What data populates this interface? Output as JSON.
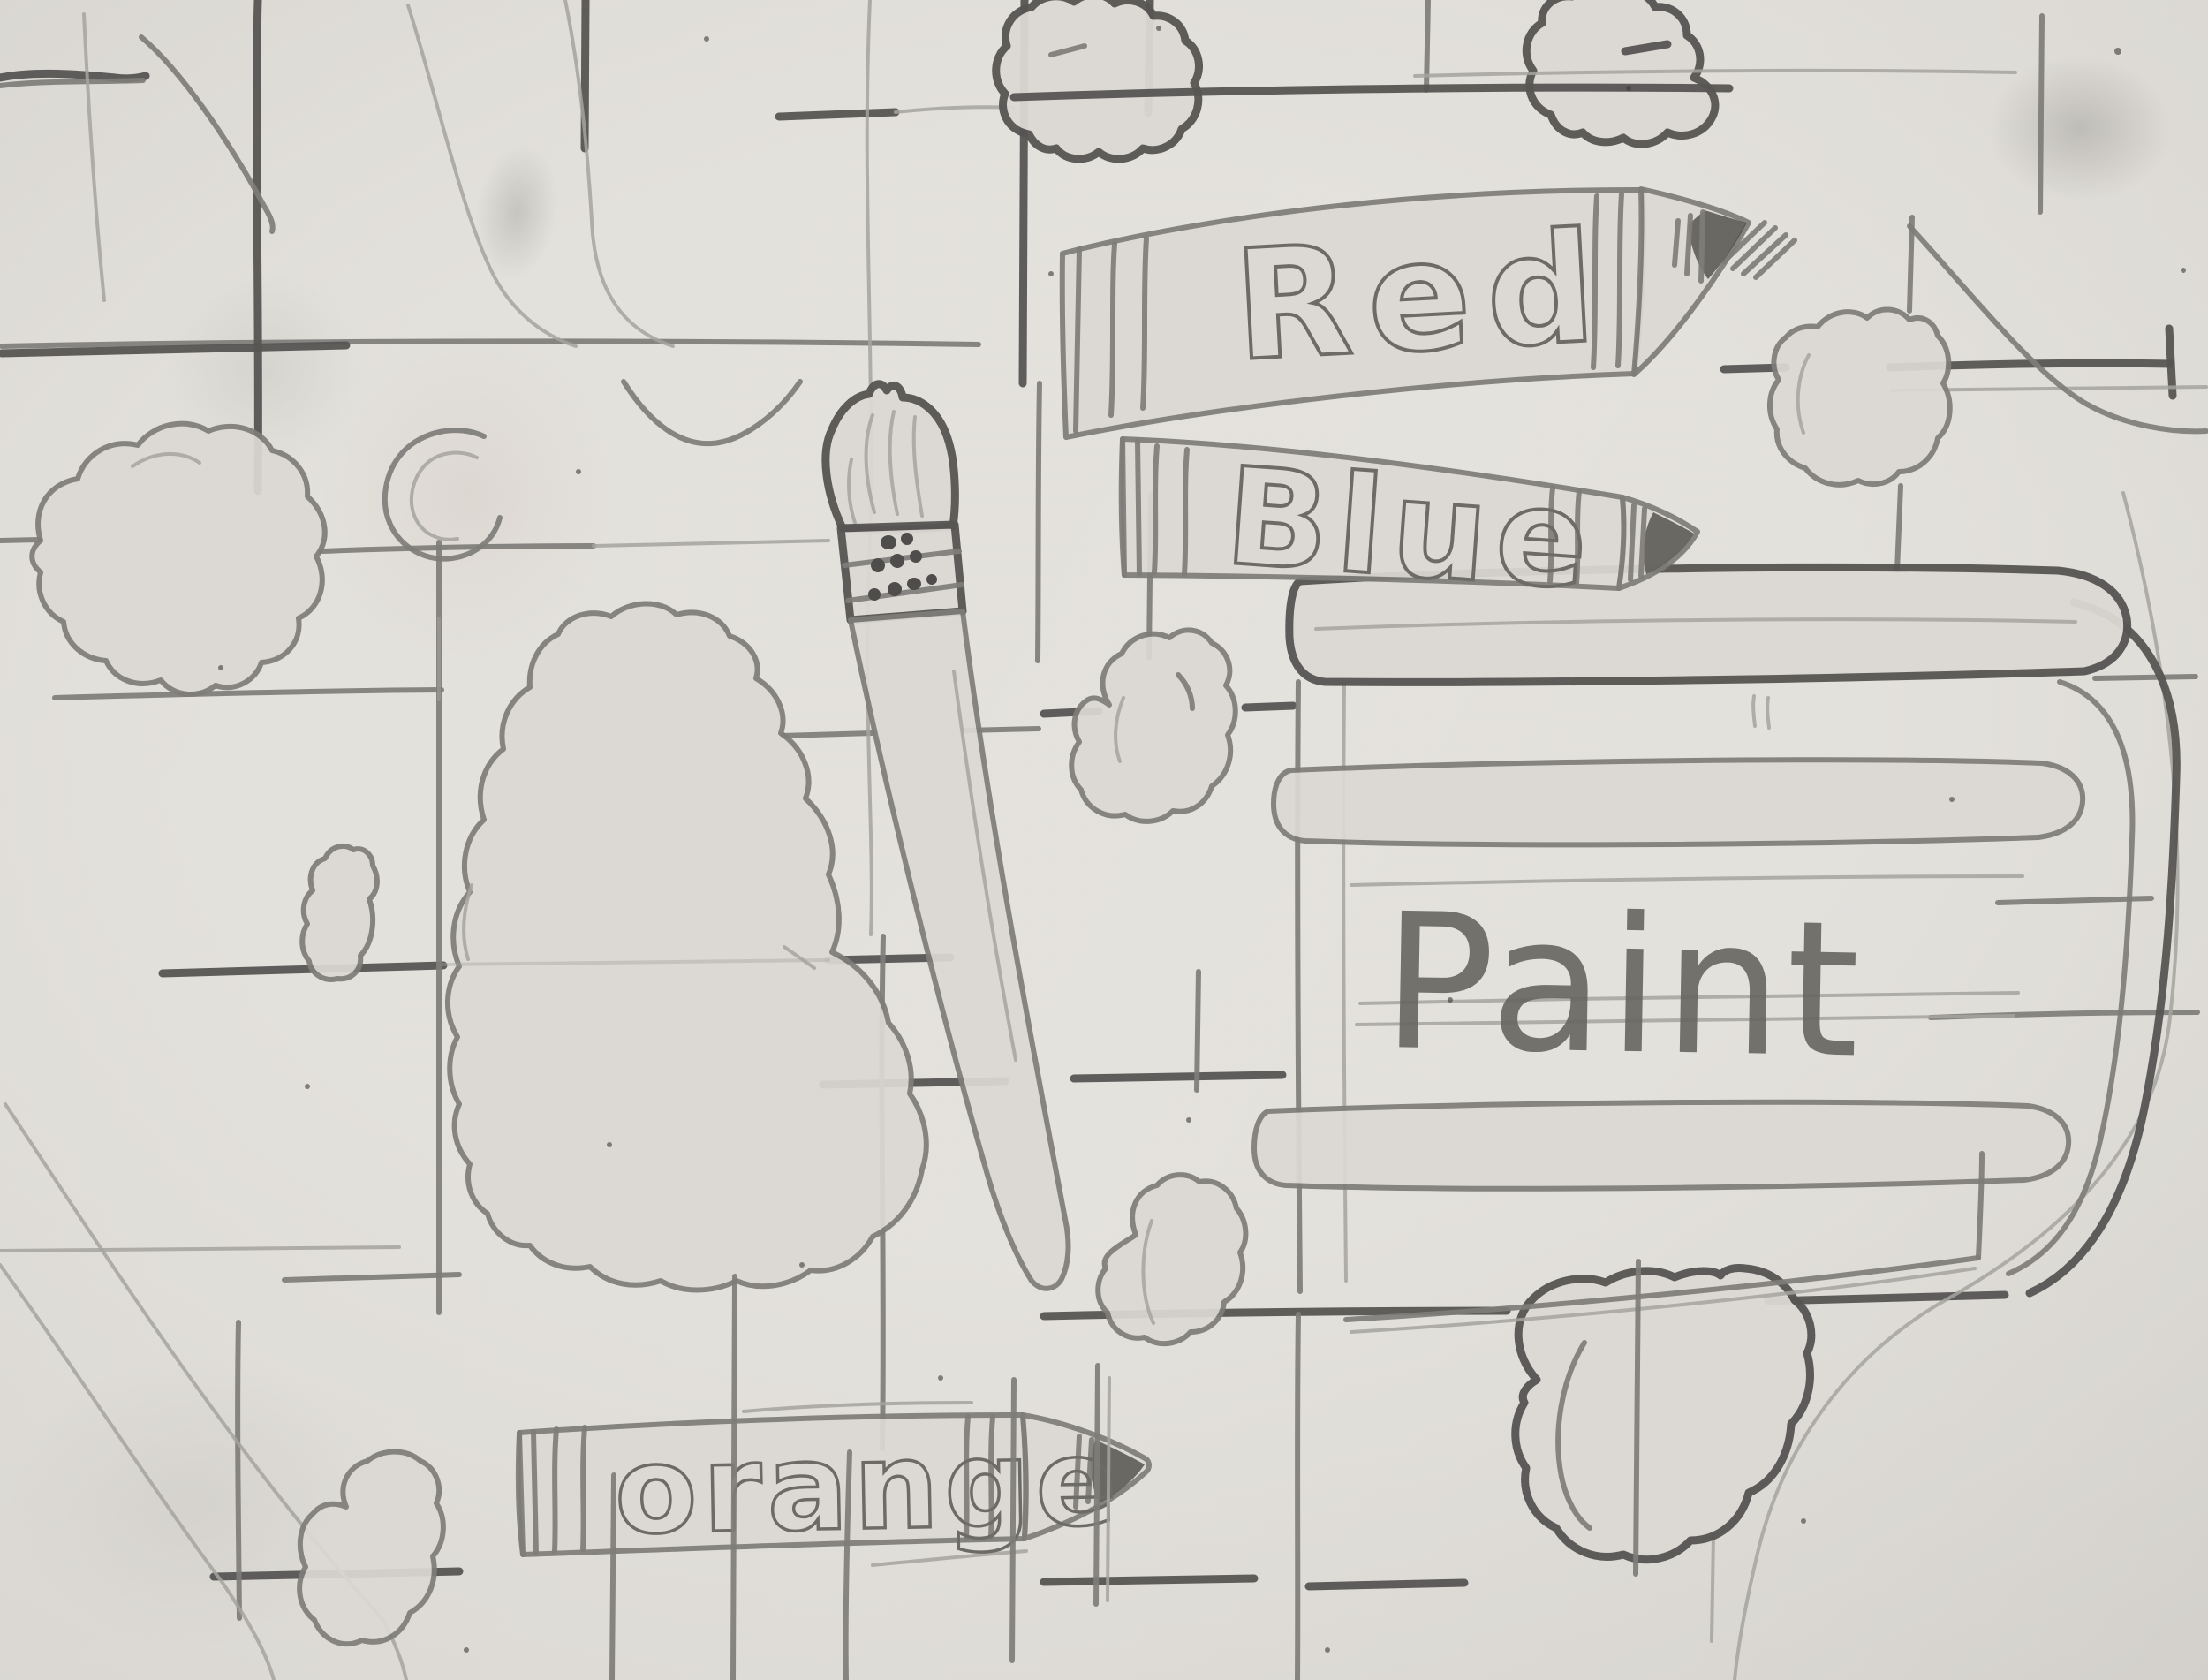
{
  "artwork": {
    "description": "Child's pencil drawing: crayons, paintbrush and paint bucket over a hand-drawn grid",
    "labels": {
      "crayon_red": "Red",
      "crayon_blue": "Blue",
      "crayon_orange": "orange",
      "paint_bucket": "Paint"
    },
    "colors": {
      "paper": "#dcd9d4",
      "pencil_light": "#a5a39e",
      "pencil_medium": "#7e7d79",
      "pencil_dark": "#565553"
    }
  }
}
